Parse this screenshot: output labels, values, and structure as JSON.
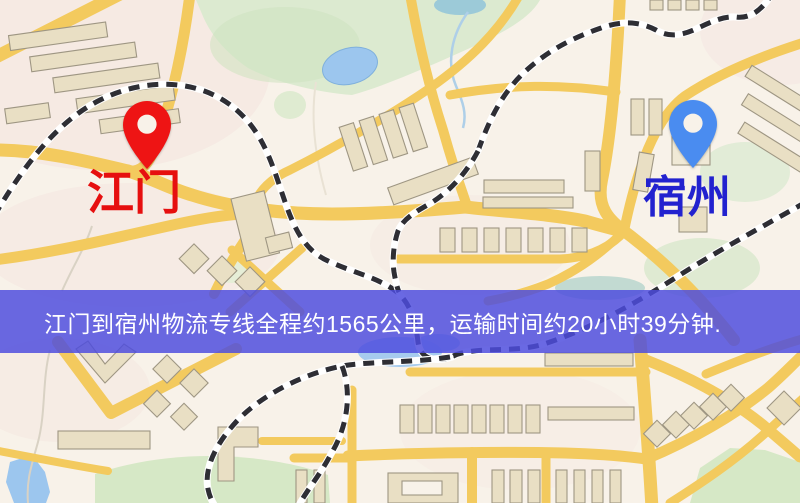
{
  "map": {
    "origin": {
      "label": "江门",
      "pin_color": "#ee1414",
      "label_color": "#e60f0f"
    },
    "destination": {
      "label": "宿州",
      "pin_color": "#4a8cf0",
      "label_color": "#2222cf"
    },
    "palette": {
      "base": "#f8f2e9",
      "road": "#f3ca5e",
      "building": "#e9dfc4",
      "building_outline": "#9e9683",
      "park": "#dcead0",
      "water": "#9cc6ee",
      "railway": "#2e2e34"
    }
  },
  "banner": {
    "text": "江门到宿州物流专线全程约1565公里，运输时间约20小时39分钟.",
    "background": "rgba(78,76,222,0.84)",
    "text_color": "#ffffff"
  }
}
